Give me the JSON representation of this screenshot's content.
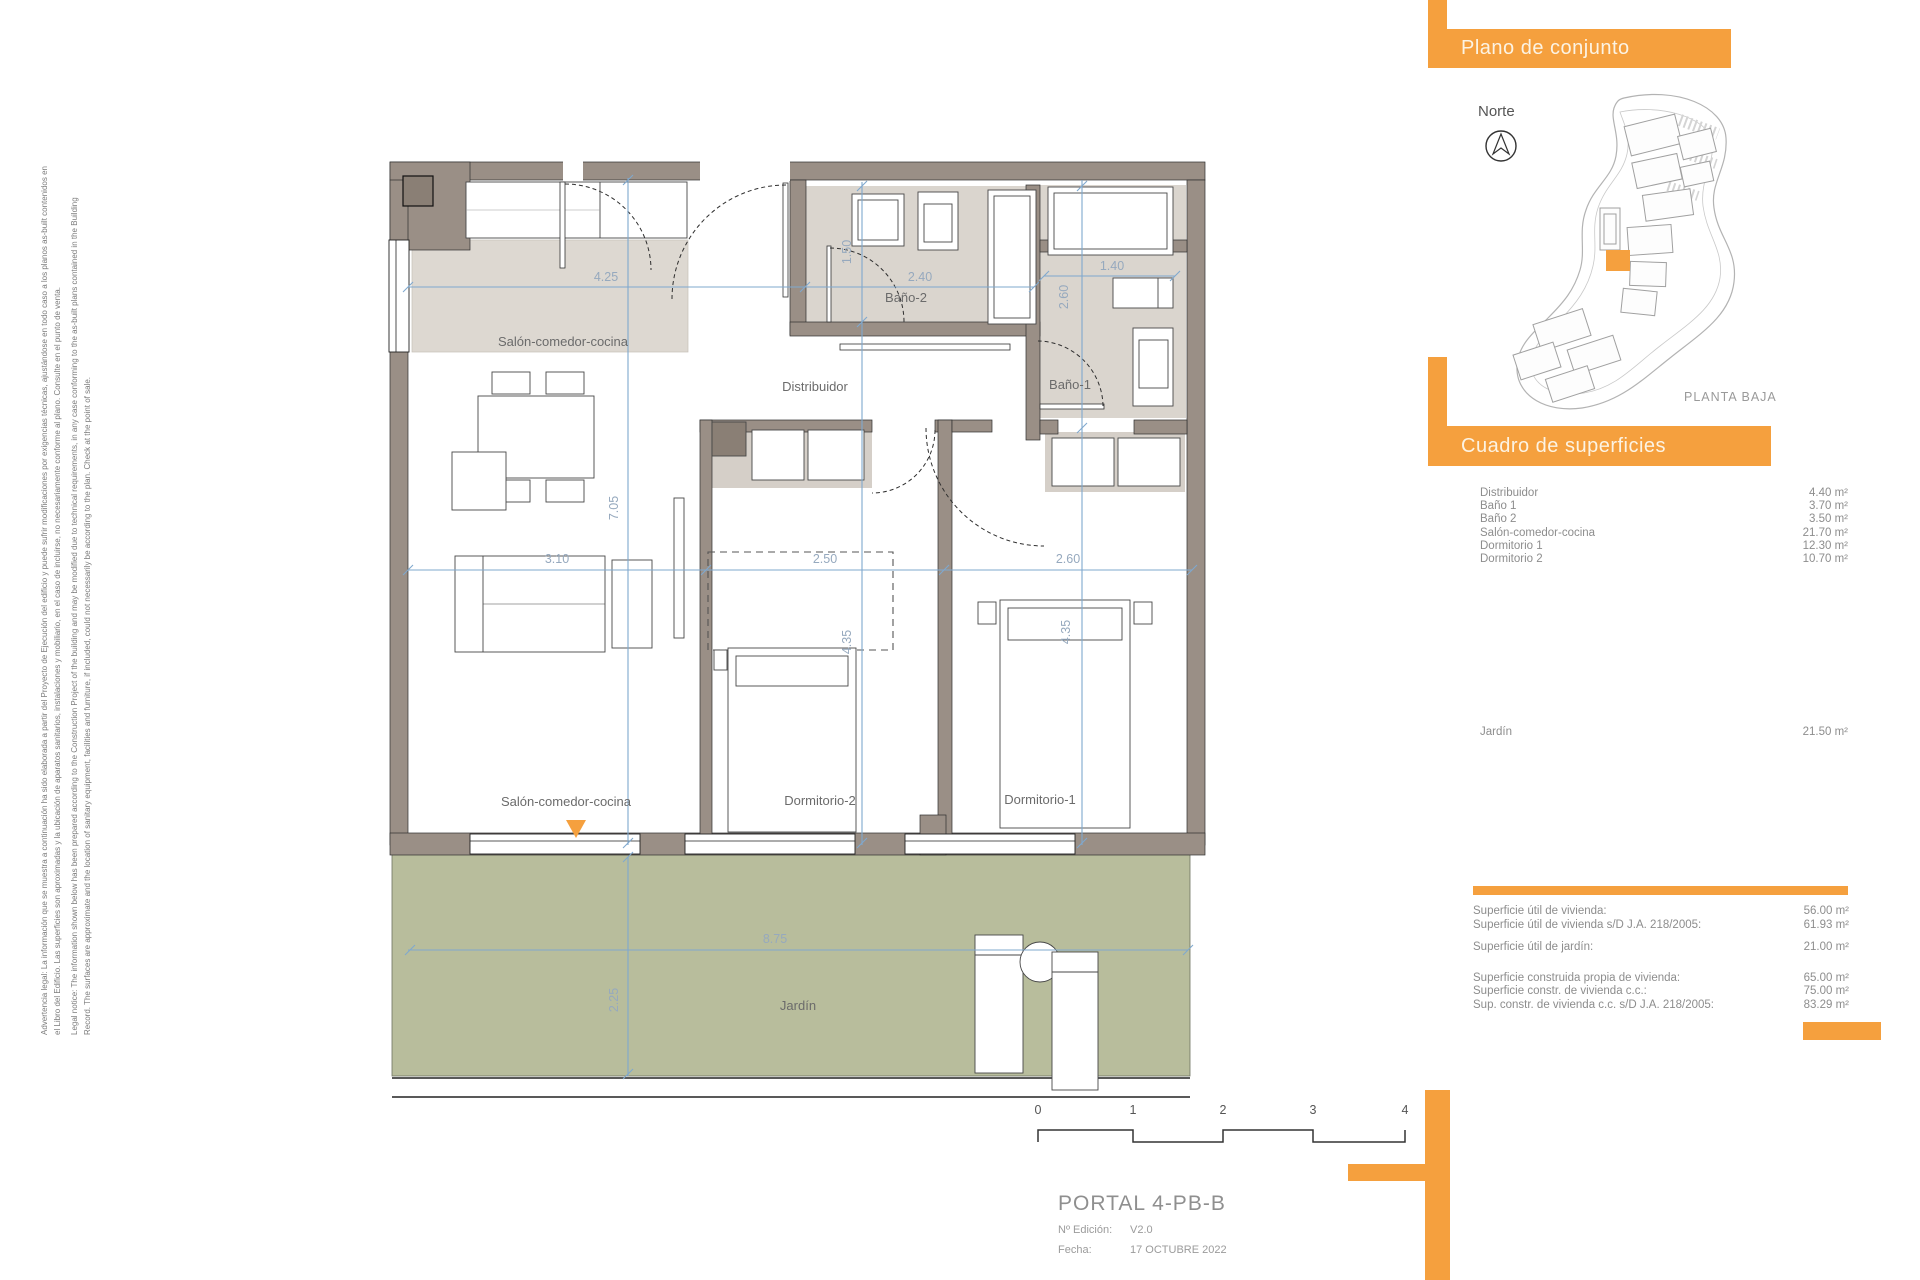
{
  "disclaimer": {
    "lines": [
      "Advertencia legal: La información que se muestra a continuación ha sido elaborada a partir del Proyecto de Ejecución del edificio y puede sufrir modificaciones por exigencias técnicas, ajustándose en todo caso a los planos as-built contenidos en",
      "el Libro del Edificio. Las superficies son aproximadas y la ubicación de aparatos sanitarios, instalaciones y mobiliario, en el caso de incluirse, no necesariamente conforme al plano. Consulte en el punto de venta.",
      "Legal notice: The information shown below has been prepared according to the Construction Project of the building and may be modified due to technical requirements, in any case conforming to the as-built plans contained in the Building",
      "Record. The surfaces are approximate and the location of sanitary equipment, facilities and furniture, if included, could not necessarily be according to the plan. Check at the point of sale."
    ]
  },
  "plan": {
    "rooms": {
      "salon_top": "Salón-comedor-cocina",
      "salon_bottom": "Salón-comedor-cocina",
      "distribuidor": "Distribuidor",
      "bano2": "Baño-2",
      "bano1": "Baño-1",
      "dorm2": "Dormitorio-2",
      "dorm1": "Dormitorio-1",
      "jardin": "Jardín"
    },
    "dims": {
      "top_salon": "4.25",
      "top_bano2": "2.40",
      "top_bano1": "1.40",
      "bano2_depth": "1.50",
      "bano1_depth": "2.60",
      "salon_height": "7.05",
      "mid_salon": "3.10",
      "mid_dorm2": "2.50",
      "mid_dorm1": "2.60",
      "dorm2_height": "4.35",
      "dorm1_height": "4.35",
      "jardin_width": "8.75",
      "jardin_depth": "2.25"
    }
  },
  "overview": {
    "banner": "Plano de conjunto",
    "north": "Norte",
    "planta": "PLANTA BAJA"
  },
  "areas": {
    "banner": "Cuadro de superficies",
    "rows": [
      {
        "label": "Distribuidor",
        "value": "4.40 m²"
      },
      {
        "label": "Baño 1",
        "value": "3.70 m²"
      },
      {
        "label": "Baño 2",
        "value": "3.50 m²"
      },
      {
        "label": "Salón-comedor-cocina",
        "value": "21.70 m²"
      },
      {
        "label": "Dormitorio 1",
        "value": "12.30 m²"
      },
      {
        "label": "Dormitorio 2",
        "value": "10.70 m²"
      }
    ],
    "garden": {
      "label": "Jardín",
      "value": "21.50 m²"
    },
    "summary": [
      {
        "label": "Superficie útil de vivienda:",
        "value": "56.00 m²"
      },
      {
        "label": "Superficie útil de vivienda s/D J.A. 218/2005:",
        "value": "61.93 m²"
      },
      {
        "label": "Superficie útil de jardín:",
        "value": "21.00 m²"
      },
      {
        "label": "Superficie construida propia de vivienda:",
        "value": "65.00 m²"
      },
      {
        "label": "Superficie constr. de vivienda c.c.:",
        "value": "75.00 m²"
      },
      {
        "label": "Sup. constr. de vivienda c.c. s/D J.A. 218/2005:",
        "value": "83.29 m²"
      }
    ]
  },
  "titleblock": {
    "portal": "PORTAL 4-PB-B",
    "edition_label": "Nº Edición:",
    "edition_value": "V2.0",
    "date_label": "Fecha:",
    "date_value": "17 OCTUBRE 2022"
  },
  "scalebar": {
    "ticks": [
      "0",
      "1",
      "2",
      "3",
      "4"
    ]
  },
  "colors": {
    "accent": "#F5A03E",
    "wall": "#9A8F86",
    "room_fill": "#DAD5CE",
    "garden": "#B8BD9C",
    "dim_blue": "#7FA8CE",
    "dim_text": "#96A9BE",
    "label_gray": "#6B6B6B"
  }
}
